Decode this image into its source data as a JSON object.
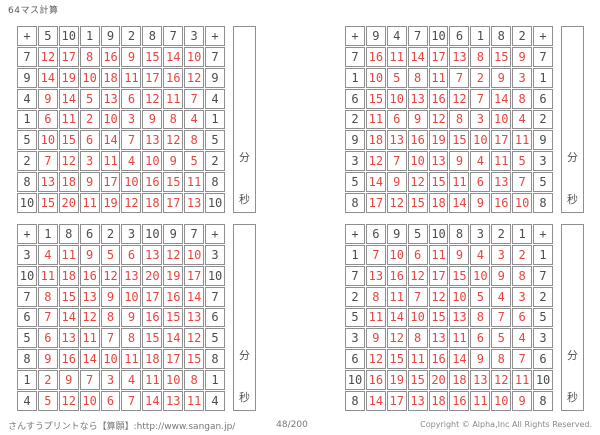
{
  "page_title": "64マス計算",
  "labels": {
    "plus": "+",
    "minutes": "分",
    "seconds": "秒"
  },
  "colors": {
    "answer": "#e64540",
    "operand": "#4c4c4c",
    "border": "#8f8f8f"
  },
  "footer": {
    "left": "さんすうプリントなら【算願】:http://www.sangan.jp/",
    "center": "48/200",
    "right": "Copyright © Alpha,Inc All Rights Reserved."
  },
  "grids": [
    {
      "position": "top-left",
      "col_headers": [
        5,
        10,
        1,
        9,
        2,
        8,
        7,
        3
      ],
      "rows": [
        {
          "operand": 7,
          "answers": [
            12,
            17,
            8,
            16,
            9,
            15,
            14,
            10
          ]
        },
        {
          "operand": 9,
          "answers": [
            14,
            19,
            10,
            18,
            11,
            17,
            16,
            12
          ]
        },
        {
          "operand": 4,
          "answers": [
            9,
            14,
            5,
            13,
            6,
            12,
            11,
            7
          ]
        },
        {
          "operand": 1,
          "answers": [
            6,
            11,
            2,
            10,
            3,
            9,
            8,
            4
          ]
        },
        {
          "operand": 5,
          "answers": [
            10,
            15,
            6,
            14,
            7,
            13,
            12,
            8
          ]
        },
        {
          "operand": 2,
          "answers": [
            7,
            12,
            3,
            11,
            4,
            10,
            9,
            5
          ]
        },
        {
          "operand": 8,
          "answers": [
            13,
            18,
            9,
            17,
            10,
            16,
            15,
            11
          ]
        },
        {
          "operand": 10,
          "answers": [
            15,
            20,
            11,
            19,
            12,
            18,
            17,
            13
          ]
        }
      ]
    },
    {
      "position": "top-right",
      "col_headers": [
        9,
        4,
        7,
        10,
        6,
        1,
        8,
        2
      ],
      "rows": [
        {
          "operand": 7,
          "answers": [
            16,
            11,
            14,
            17,
            13,
            8,
            15,
            9
          ]
        },
        {
          "operand": 1,
          "answers": [
            10,
            5,
            8,
            11,
            7,
            2,
            9,
            3
          ]
        },
        {
          "operand": 6,
          "answers": [
            15,
            10,
            13,
            16,
            12,
            7,
            14,
            8
          ]
        },
        {
          "operand": 2,
          "answers": [
            11,
            6,
            9,
            12,
            8,
            3,
            10,
            4
          ]
        },
        {
          "operand": 9,
          "answers": [
            18,
            13,
            16,
            19,
            15,
            10,
            17,
            11
          ]
        },
        {
          "operand": 3,
          "answers": [
            12,
            7,
            10,
            13,
            9,
            4,
            11,
            5
          ]
        },
        {
          "operand": 5,
          "answers": [
            14,
            9,
            12,
            15,
            11,
            6,
            13,
            7
          ]
        },
        {
          "operand": 8,
          "answers": [
            17,
            12,
            15,
            18,
            14,
            9,
            16,
            10
          ]
        }
      ]
    },
    {
      "position": "bottom-left",
      "col_headers": [
        1,
        8,
        6,
        2,
        3,
        10,
        9,
        7
      ],
      "rows": [
        {
          "operand": 3,
          "answers": [
            4,
            11,
            9,
            5,
            6,
            13,
            12,
            10
          ]
        },
        {
          "operand": 10,
          "answers": [
            11,
            18,
            16,
            12,
            13,
            20,
            19,
            17
          ]
        },
        {
          "operand": 7,
          "answers": [
            8,
            15,
            13,
            9,
            10,
            17,
            16,
            14
          ]
        },
        {
          "operand": 6,
          "answers": [
            7,
            14,
            12,
            8,
            9,
            16,
            15,
            13
          ]
        },
        {
          "operand": 5,
          "answers": [
            6,
            13,
            11,
            7,
            8,
            15,
            14,
            12
          ]
        },
        {
          "operand": 8,
          "answers": [
            9,
            16,
            14,
            10,
            11,
            18,
            17,
            15
          ]
        },
        {
          "operand": 1,
          "answers": [
            2,
            9,
            7,
            3,
            4,
            11,
            10,
            8
          ]
        },
        {
          "operand": 4,
          "answers": [
            5,
            12,
            10,
            6,
            7,
            14,
            13,
            11
          ]
        }
      ]
    },
    {
      "position": "bottom-right",
      "col_headers": [
        6,
        9,
        5,
        10,
        8,
        3,
        2,
        1
      ],
      "rows": [
        {
          "operand": 1,
          "answers": [
            7,
            10,
            6,
            11,
            9,
            4,
            3,
            2
          ]
        },
        {
          "operand": 7,
          "answers": [
            13,
            16,
            12,
            17,
            15,
            10,
            9,
            8
          ]
        },
        {
          "operand": 2,
          "answers": [
            8,
            11,
            7,
            12,
            10,
            5,
            4,
            3
          ]
        },
        {
          "operand": 5,
          "answers": [
            11,
            14,
            10,
            15,
            13,
            8,
            7,
            6
          ]
        },
        {
          "operand": 3,
          "answers": [
            9,
            12,
            8,
            13,
            11,
            6,
            5,
            4
          ]
        },
        {
          "operand": 6,
          "answers": [
            12,
            15,
            11,
            16,
            14,
            9,
            8,
            7
          ]
        },
        {
          "operand": 10,
          "answers": [
            16,
            19,
            15,
            20,
            18,
            13,
            12,
            11
          ]
        },
        {
          "operand": 8,
          "answers": [
            14,
            17,
            13,
            18,
            16,
            11,
            10,
            9
          ]
        }
      ]
    }
  ]
}
